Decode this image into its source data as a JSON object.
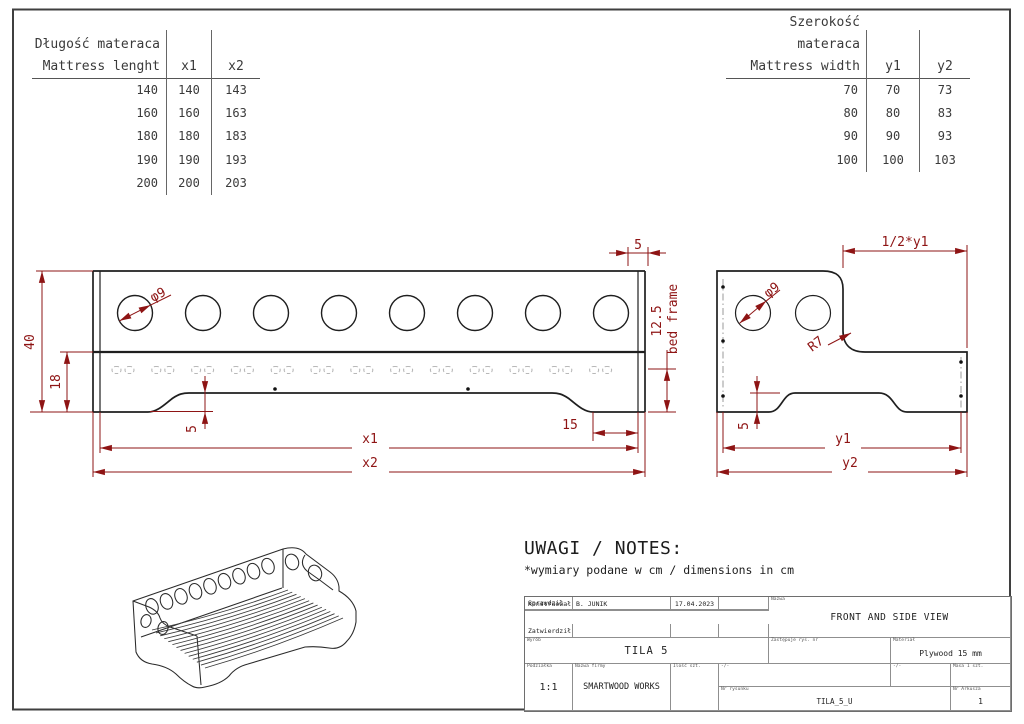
{
  "length_table": {
    "title_pl": "Długość materaca",
    "title_en": "Mattress lenght",
    "col1": "x1",
    "col2": "x2",
    "rows": [
      [
        "140",
        "140",
        "143"
      ],
      [
        "160",
        "160",
        "163"
      ],
      [
        "180",
        "180",
        "183"
      ],
      [
        "190",
        "190",
        "193"
      ],
      [
        "200",
        "200",
        "203"
      ]
    ]
  },
  "width_table": {
    "title_pl": "Szerokość materaca",
    "title_en": "Mattress width",
    "col1": "y1",
    "col2": "y2",
    "rows": [
      [
        "70",
        "70",
        "73"
      ],
      [
        "80",
        "80",
        "83"
      ],
      [
        "90",
        "90",
        "93"
      ],
      [
        "100",
        "100",
        "103"
      ]
    ]
  },
  "front_view": {
    "height": "40",
    "upper_height": "18",
    "hole_dia": "φ9",
    "edge_offset": "5",
    "frame_height": "12.5",
    "frame_label": "bed frame",
    "foot_height": "5",
    "foot_inset": "15",
    "dim_x1": "x1",
    "dim_x2": "x2"
  },
  "side_view": {
    "half_width": "1/2*y1",
    "hole_dia": "φ9",
    "corner_radius": "R7",
    "foot_height": "5",
    "dim_y1": "y1",
    "dim_y2": "y2"
  },
  "notes": {
    "heading": "UWAGI / NOTES:",
    "line1": "*wymiary podane w cm / dimensions in cm"
  },
  "title_block": {
    "designed_label": "Konstruował",
    "designed_value": "B. JUNIK",
    "date": "17.04.2023",
    "checked_label": "Sprawdził",
    "approved_label": "Zatwierdził",
    "product_label": "Wyrób",
    "product": "TILA 5",
    "name_label": "Nazwa",
    "name": "FRONT AND SIDE VIEW",
    "replaces_label": "Zastępuje rys. nr",
    "material_label": "Materiał",
    "material": "Plywood 15 mm",
    "scale_label": "Podziałka",
    "scale": "1:1",
    "company_label": "Nazwa firmy",
    "company": "SMARTWOOD WORKS",
    "qty_label": "Ilość szt.",
    "misc1_label": "-/-",
    "misc2_label": "-/-",
    "mass_label": "Masa 1 szt.",
    "drawing_no_label": "Nr rysunku",
    "drawing_no": "TILA_5_U",
    "sheet_label": "Nr Arkusza",
    "sheet": "1"
  }
}
